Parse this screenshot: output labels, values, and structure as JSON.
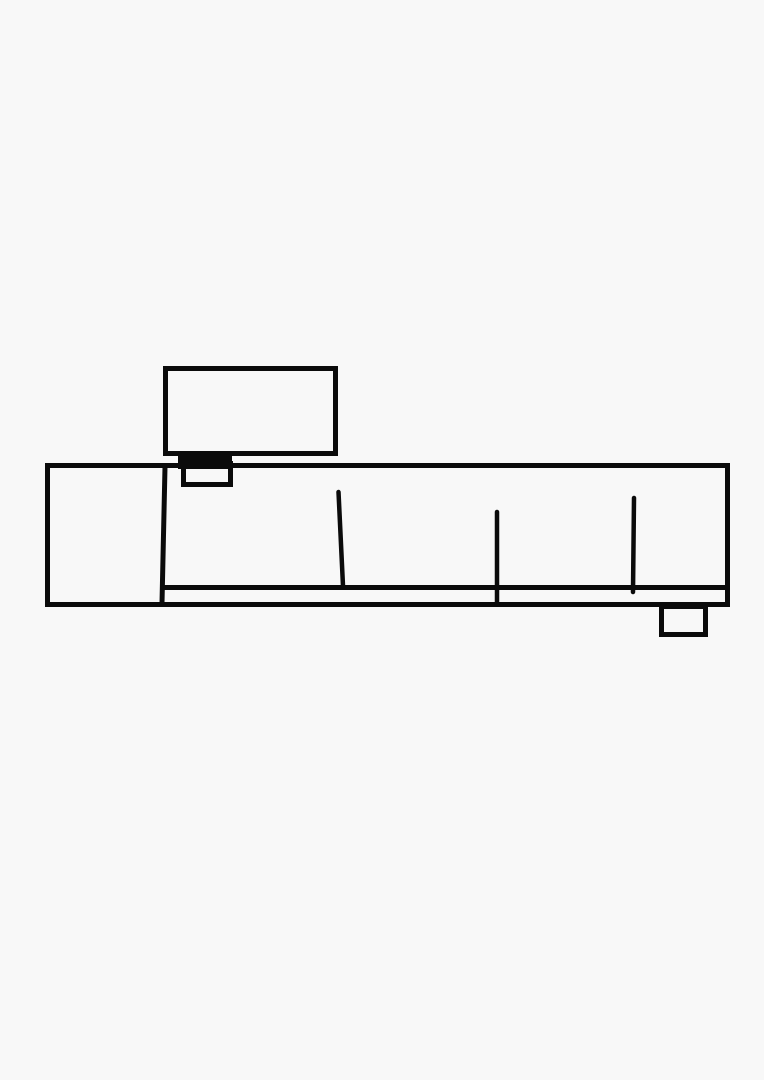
{
  "canvas": {
    "width": 764,
    "height": 1080,
    "background_color": "#f8f8f8",
    "stroke_color": "#0b0b0b"
  },
  "sketch": {
    "shapes": [
      {
        "name": "tv-screen-outline",
        "type": "rect",
        "x": 165.5,
        "y": 368.5,
        "w": 170,
        "h": 85,
        "fill": "none",
        "sw": 5
      },
      {
        "name": "console-outline",
        "type": "rect",
        "x": 47.5,
        "y": 465.5,
        "w": 680,
        "h": 139,
        "fill": "none",
        "sw": 5
      },
      {
        "name": "tv-stand-bar",
        "type": "rect",
        "x": 178,
        "y": 455,
        "w": 54,
        "h": 14,
        "fill": "#0b0b0b",
        "sw": 0
      },
      {
        "name": "tv-stand-foot-outline",
        "type": "rect",
        "x": 183.5,
        "y": 463.5,
        "w": 47,
        "h": 21,
        "fill": "none",
        "sw": 5
      },
      {
        "name": "console-left-divider",
        "type": "line",
        "x1": 165,
        "y1": 467,
        "x2": 162,
        "y2": 603,
        "sw": 5
      },
      {
        "name": "console-shelf-line",
        "type": "line",
        "x1": 163,
        "y1": 587.5,
        "x2": 727,
        "y2": 587.5,
        "sw": 5
      },
      {
        "name": "console-seam-1",
        "type": "line",
        "x1": 338.5,
        "y1": 492,
        "x2": 343,
        "y2": 586,
        "sw": 4.5
      },
      {
        "name": "console-seam-2",
        "type": "line",
        "x1": 497,
        "y1": 512,
        "x2": 497,
        "y2": 604,
        "sw": 4.5
      },
      {
        "name": "console-seam-3",
        "type": "line",
        "x1": 634,
        "y1": 498,
        "x2": 633,
        "y2": 592,
        "sw": 4.5
      },
      {
        "name": "console-right-foot-outline",
        "type": "rect",
        "x": 661.5,
        "y": 606.5,
        "w": 44,
        "h": 28,
        "fill": "none",
        "sw": 5
      }
    ]
  }
}
